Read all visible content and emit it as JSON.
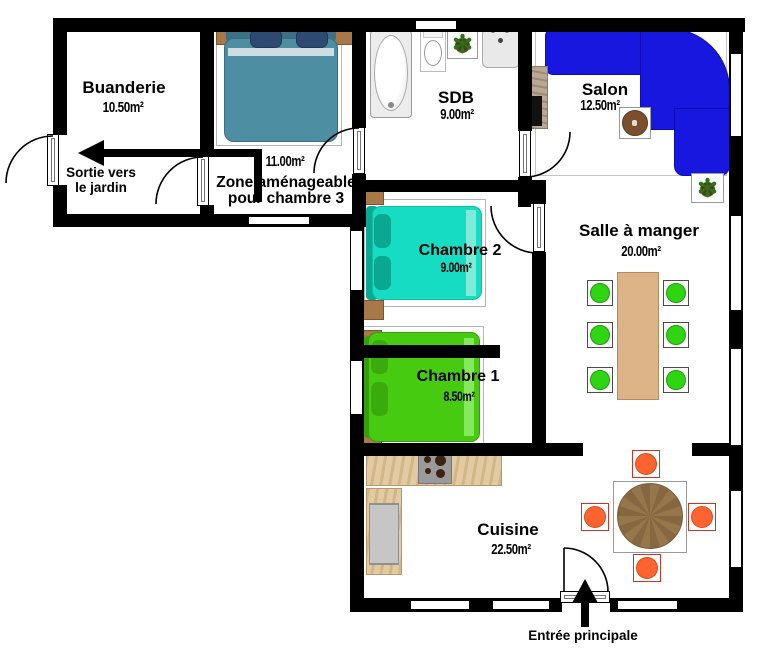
{
  "plan": {
    "rooms": {
      "buanderie": {
        "name": "Buanderie",
        "area": "10.50m²"
      },
      "zone_chambre3": {
        "area": "11.00m²",
        "name_line1": "Zone aménageable",
        "name_line2": "pour chambre 3"
      },
      "sdb": {
        "name": "SDB",
        "area": "9.00m²"
      },
      "salon": {
        "name": "Salon",
        "area": "12.50m²"
      },
      "chambre2": {
        "name": "Chambre 2",
        "area": "9.00m²"
      },
      "chambre1": {
        "name": "Chambre 1",
        "area": "8.50m²"
      },
      "salle_a_manger": {
        "name": "Salle à manger",
        "area": "20.00m²"
      },
      "cuisine": {
        "name": "Cuisine",
        "area": "22.50m²"
      }
    },
    "annotations": {
      "sortie_jardin_line1": "Sortie vers",
      "sortie_jardin_line2": "le jardin",
      "entree_principale": "Entrée principale"
    },
    "plant_glyph": "✻",
    "colors": {
      "wall": "#000000",
      "sofa_blue": "#1717e0",
      "bed_teal": "#4e8ea2",
      "bed_turquoise": "#16dcc4",
      "bed_green": "#46cb10",
      "dining_chair_green": "#2fd513",
      "kitchen_chair_orange": "#ff6430",
      "dining_table_wood": "#dcb488",
      "round_table_wood": "#96764b",
      "counter_wood": "#e2cba2"
    }
  }
}
